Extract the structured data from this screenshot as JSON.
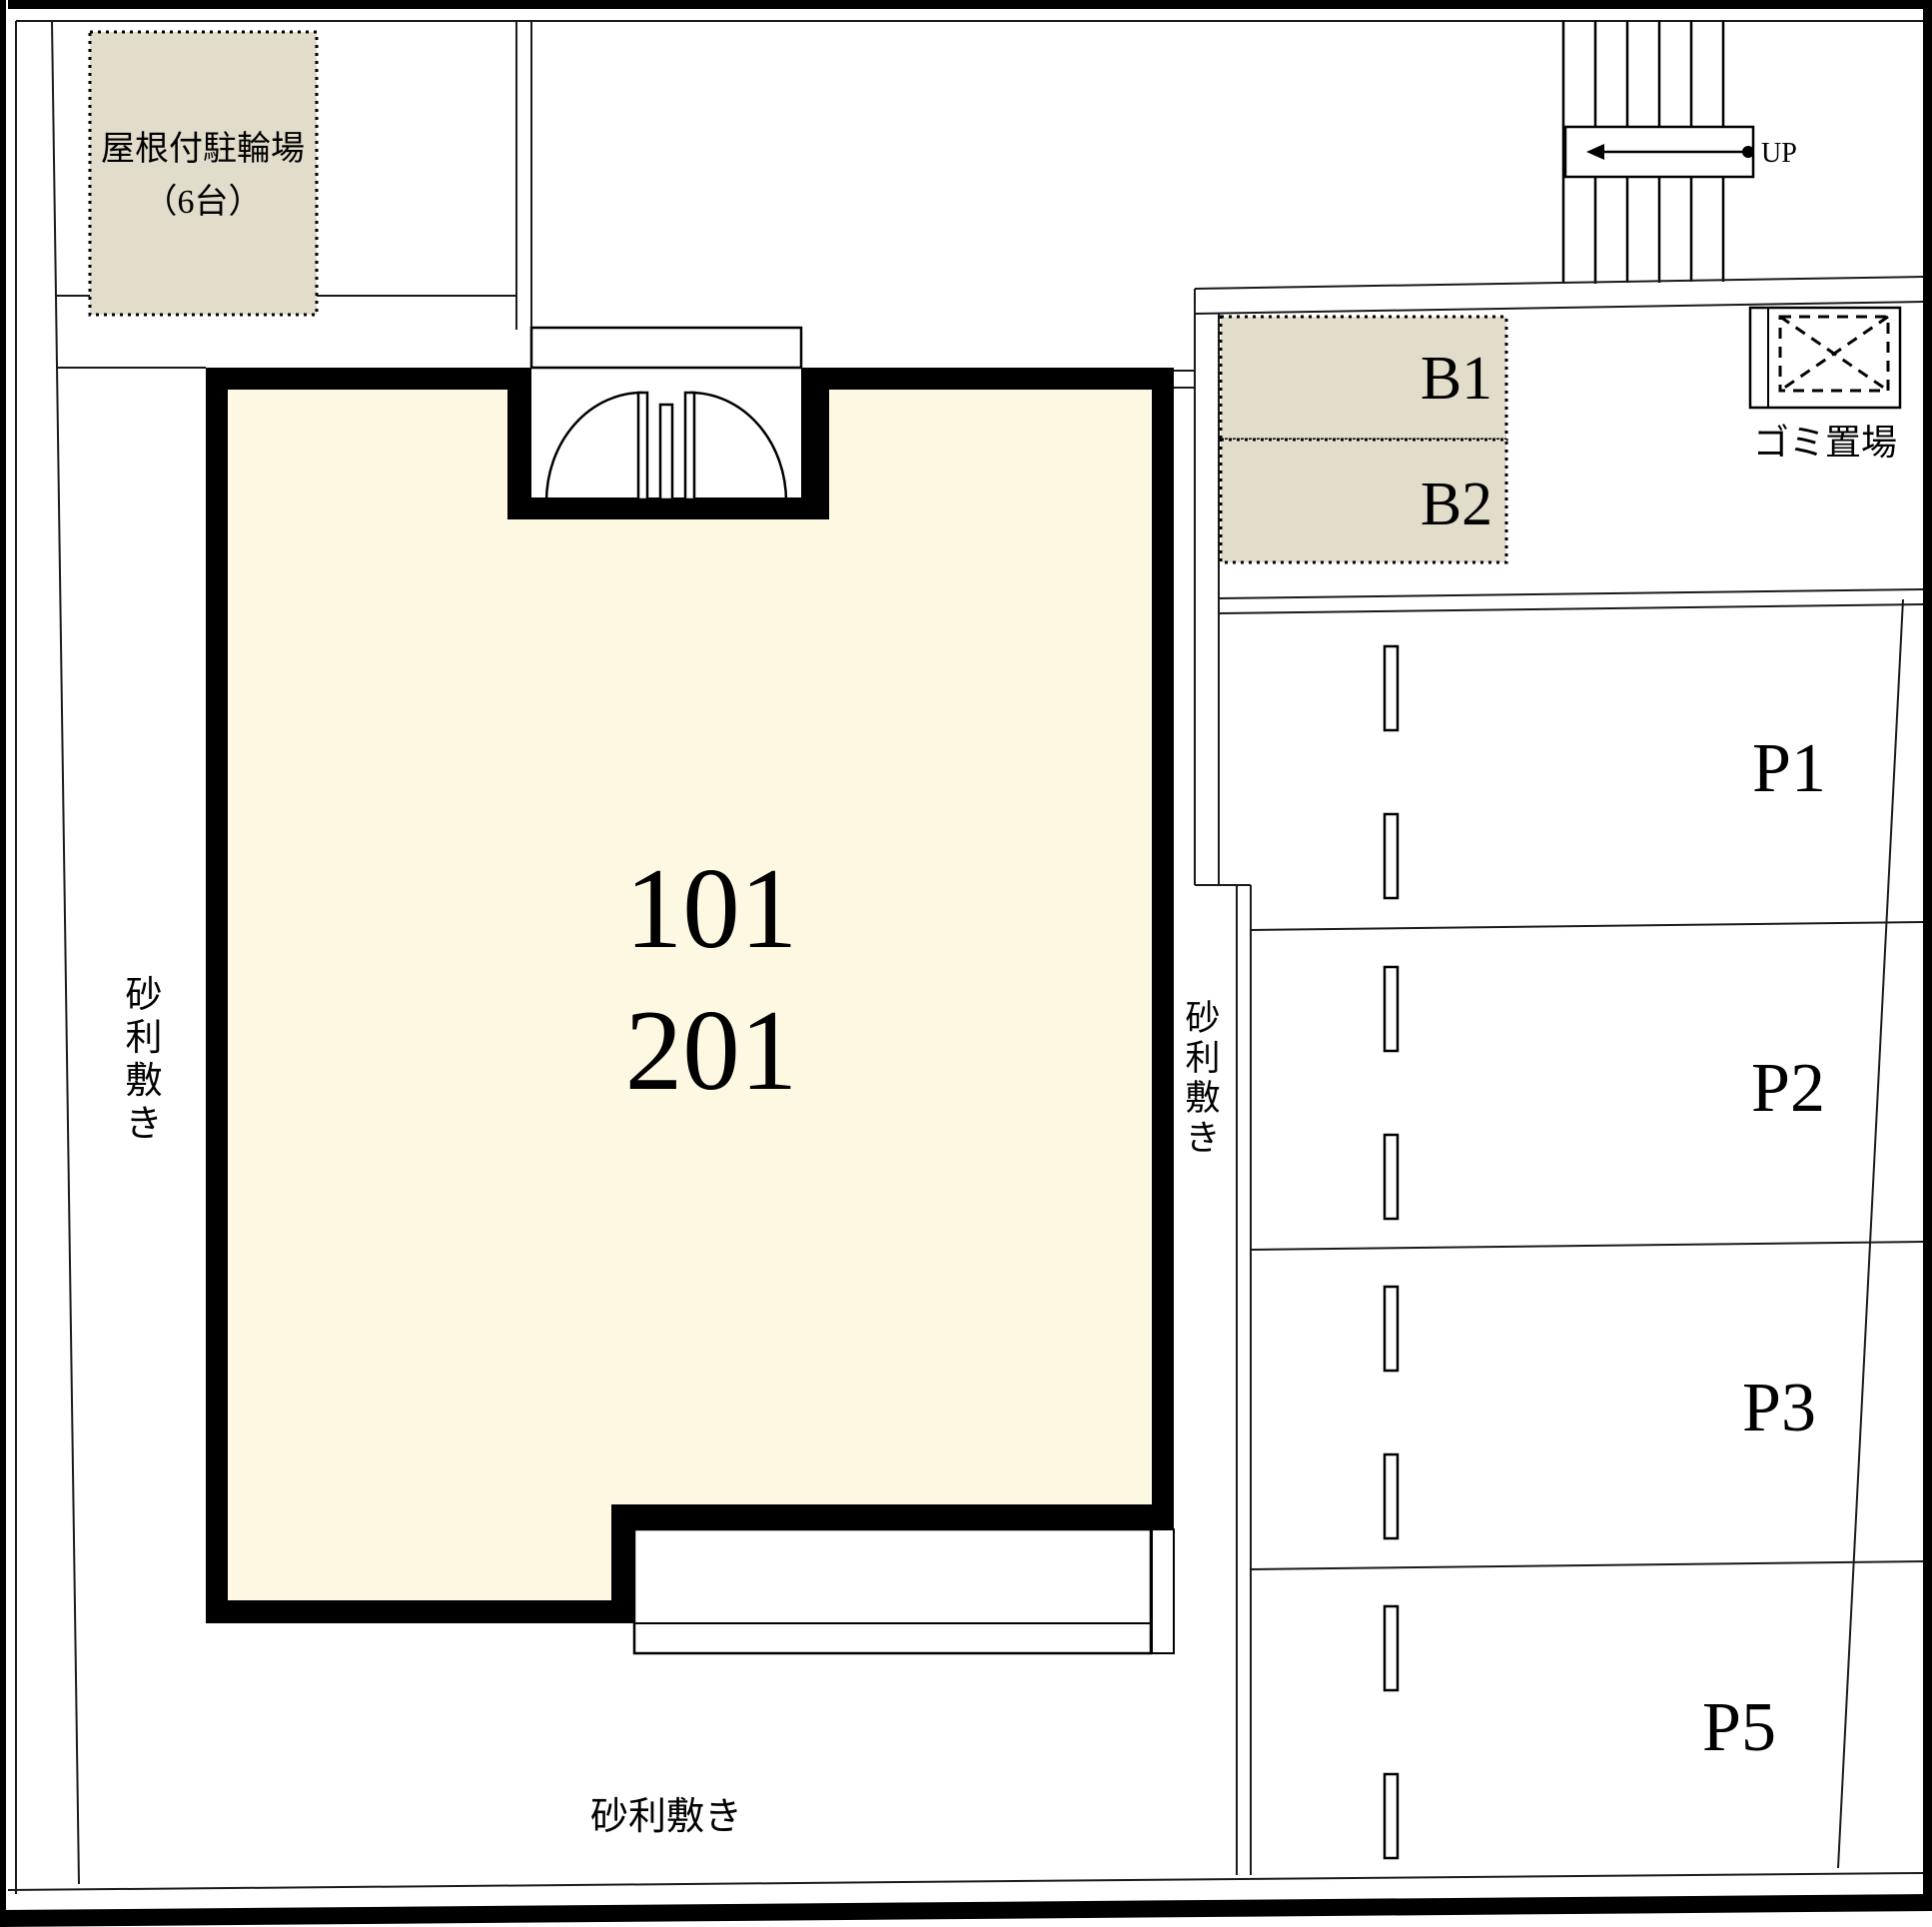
{
  "plan": {
    "title_hint": "site plan",
    "bicycle_parking": {
      "label_line1": "屋根付駐輪場",
      "label_line2": "（6台）"
    },
    "building": {
      "unit_first_floor": "101",
      "unit_second_floor": "201"
    },
    "bike_stalls": [
      "B1",
      "B2"
    ],
    "garbage_label": "ゴミ置場",
    "stairs_label": "UP",
    "parking_stalls": [
      "P1",
      "P2",
      "P3",
      "P5"
    ],
    "gravel_left": "砂利敷き",
    "gravel_right": "砂利敷き",
    "gravel_bottom": "砂利敷き",
    "colors": {
      "room_fill": "#FDF8E1",
      "stall_fill": "#E2DDCB",
      "line": "#000000",
      "background": "#FFFFFF"
    }
  }
}
